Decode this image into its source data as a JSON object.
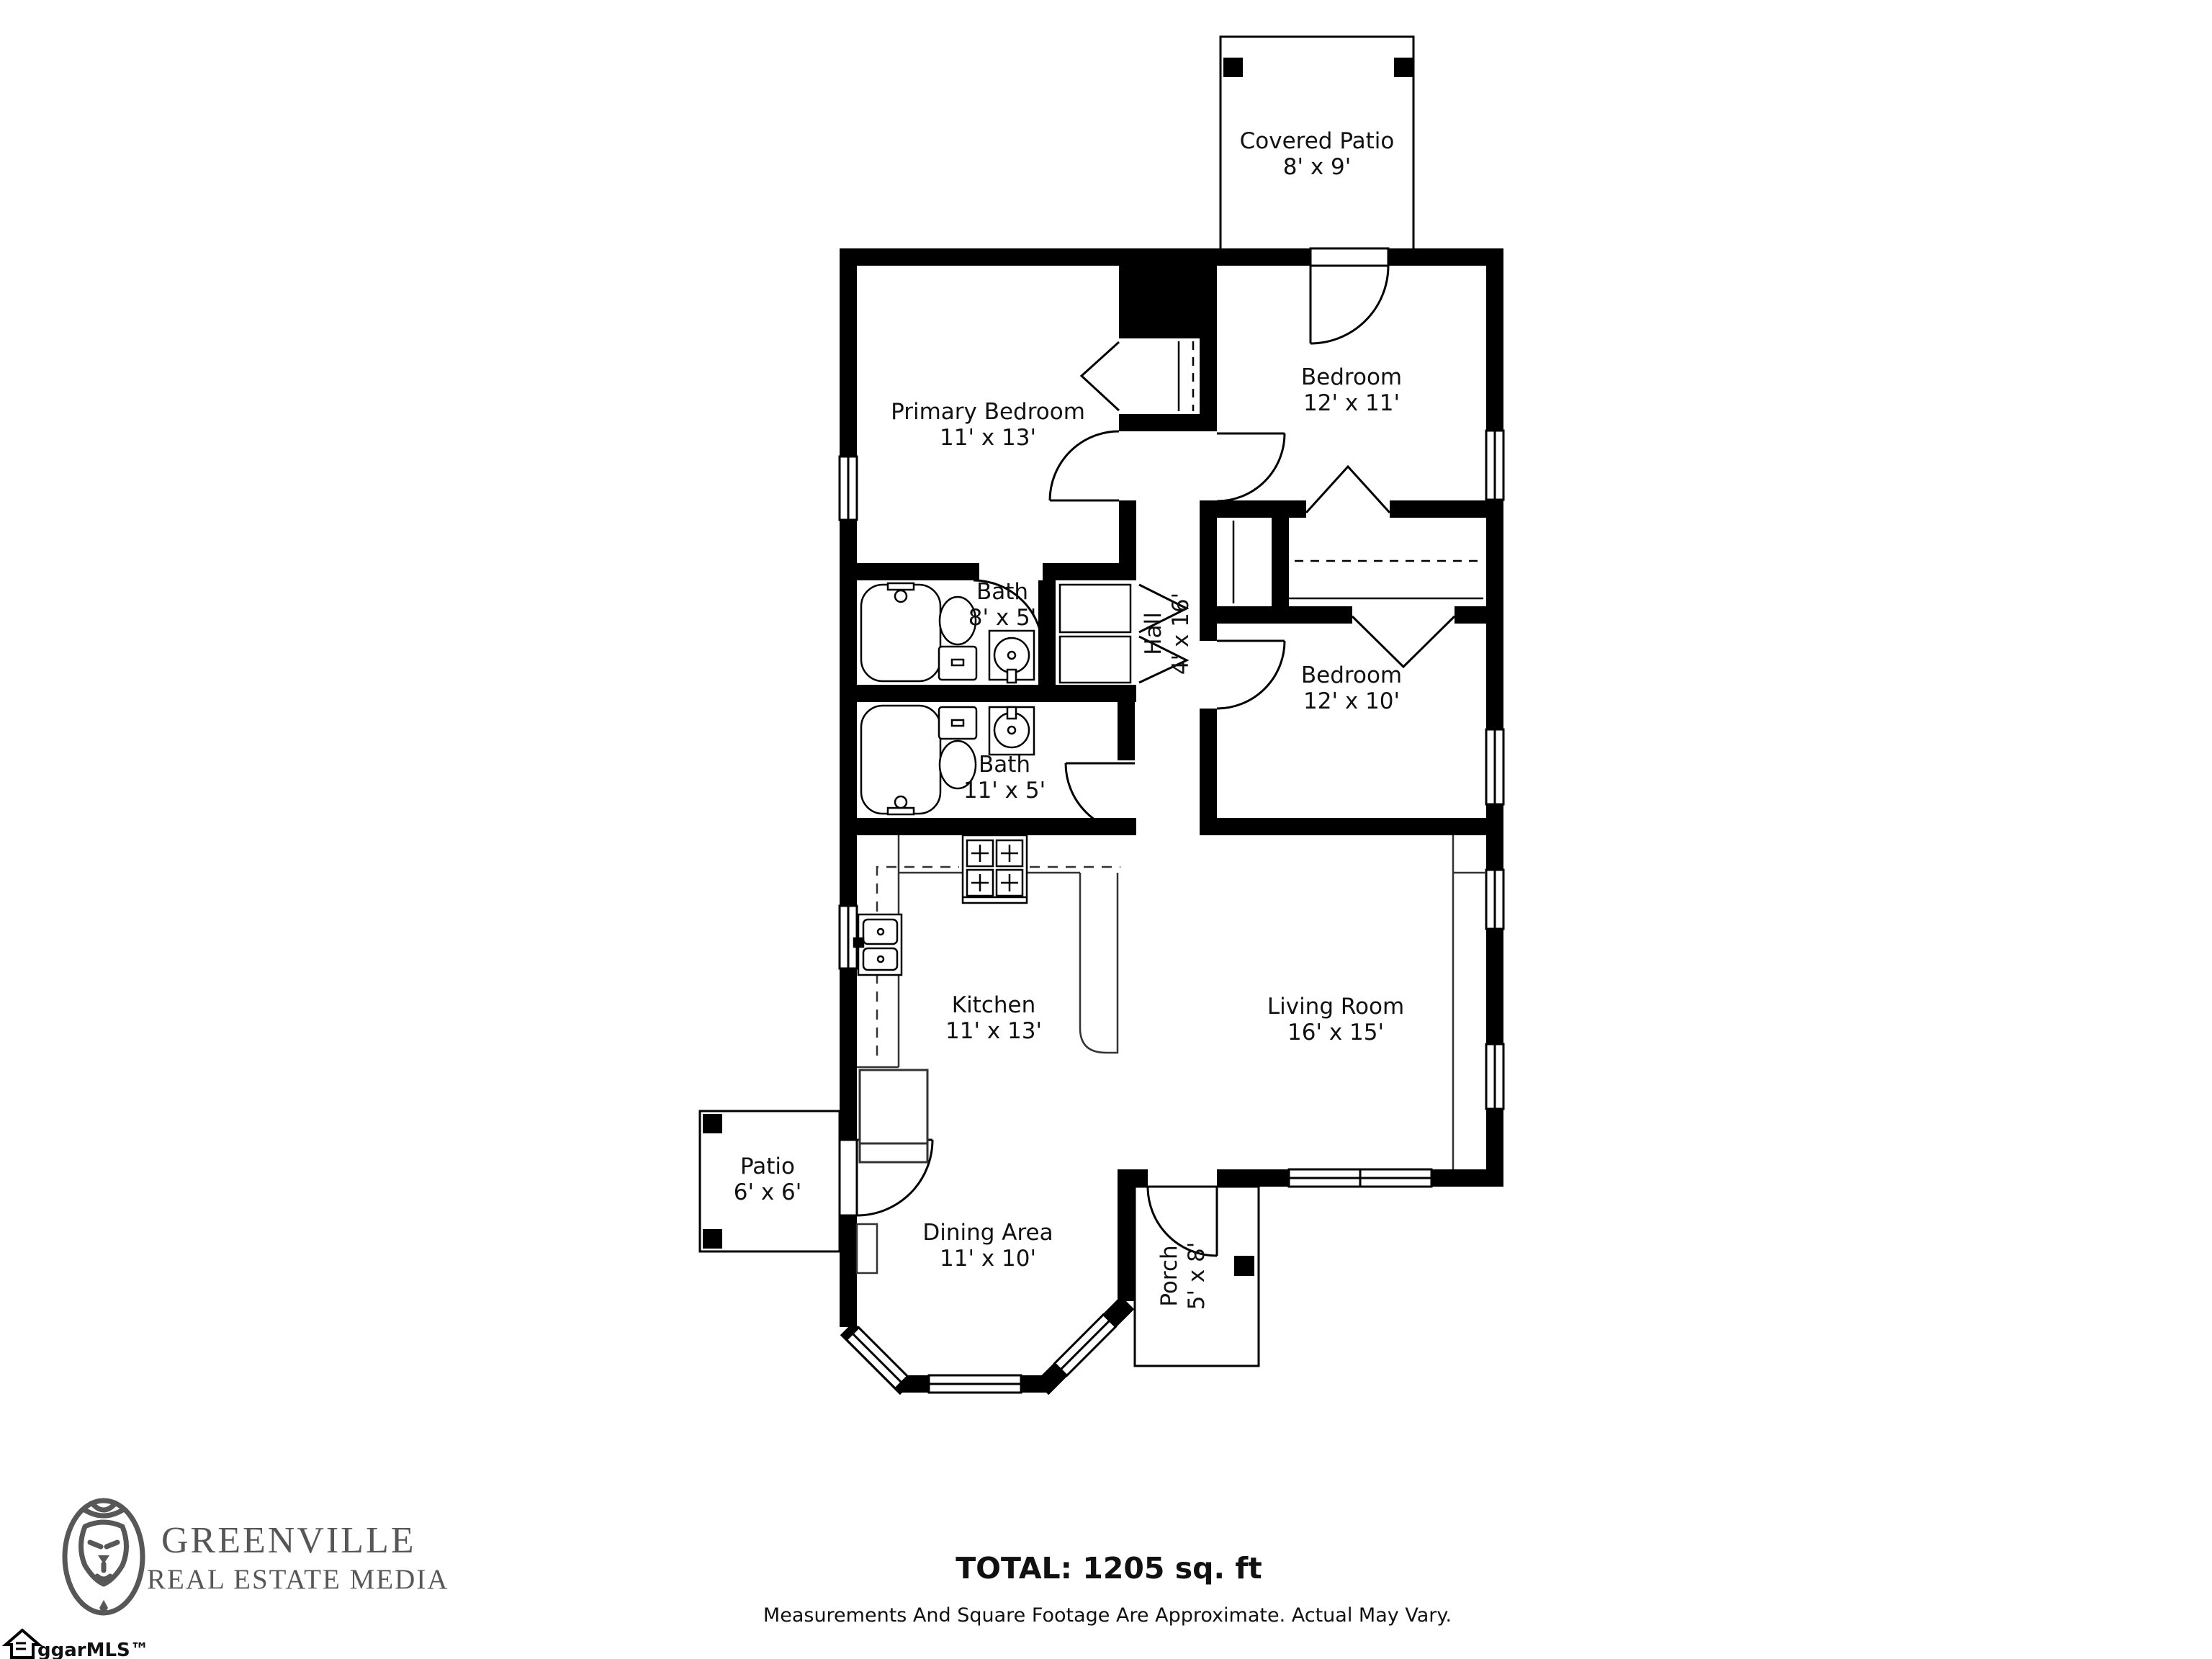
{
  "title": "Floor Plan",
  "floor_plan": {
    "rooms": [
      {
        "name": "Covered Patio",
        "dims": "8' x 9'"
      },
      {
        "name": "Primary Bedroom",
        "dims": "11' x 13'"
      },
      {
        "name": "Bedroom",
        "dims": "12' x 11'"
      },
      {
        "name": "Bath",
        "dims": "8' x 5'"
      },
      {
        "name": "Hall",
        "dims": "4' x 16'"
      },
      {
        "name": "Bath",
        "dims": "11' x 5'"
      },
      {
        "name": "Bedroom",
        "dims": "12' x 10'"
      },
      {
        "name": "Kitchen",
        "dims": "11' x 13'"
      },
      {
        "name": "Living Room",
        "dims": "16' x 15'"
      },
      {
        "name": "Patio",
        "dims": "6' x 6'"
      },
      {
        "name": "Dining Area",
        "dims": "11' x 10'"
      },
      {
        "name": "Porch",
        "dims": "5' x 8'"
      }
    ]
  },
  "footer": {
    "brand_line1": "GREENVILLE",
    "brand_line2": "REAL ESTATE MEDIA",
    "total": "TOTAL: 1205 sq. ft",
    "disclaimer": "Measurements And Square Footage Are Approximate. Actual May Vary."
  },
  "watermark": "ggarMLS™",
  "colors": {
    "wall": "#000000",
    "background": "#ffffff",
    "logo_gray": "#575757"
  }
}
